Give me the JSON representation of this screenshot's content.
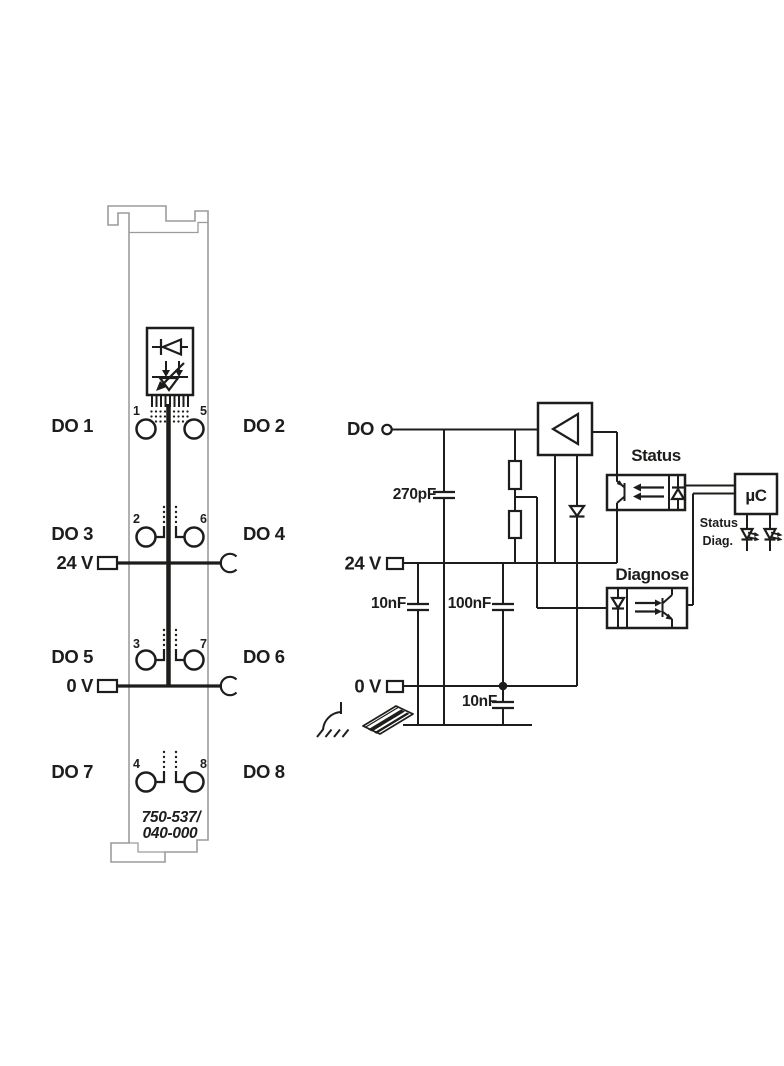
{
  "module": {
    "part_number": {
      "line1": "750-537/",
      "line2": "040-000"
    },
    "v24": "24 V",
    "v0": "0 V",
    "channels": [
      {
        "do": "DO 1",
        "pin": "1"
      },
      {
        "do": "DO 2",
        "pin": "5"
      },
      {
        "do": "DO 3",
        "pin": "2"
      },
      {
        "do": "DO 4",
        "pin": "6"
      },
      {
        "do": "DO 5",
        "pin": "3"
      },
      {
        "do": "DO 6",
        "pin": "7"
      },
      {
        "do": "DO 7",
        "pin": "4"
      },
      {
        "do": "DO 8",
        "pin": "8"
      }
    ]
  },
  "schematic": {
    "do": "DO",
    "v24": "24 V",
    "v0": "0 V",
    "cap_270pf": "270pF",
    "cap_10nf_top": "10nF",
    "cap_100nf": "100nF",
    "cap_10nf_bottom": "10nF",
    "status_optocoupler": "Status",
    "diagnose_optocoupler": "Diagnose",
    "microcontroller": "µC",
    "led_status": "Status",
    "led_diag": "Diag."
  }
}
